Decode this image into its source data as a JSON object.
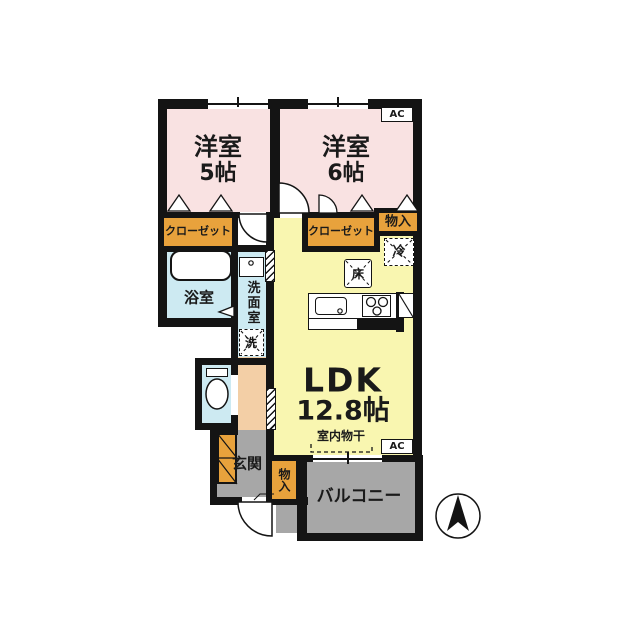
{
  "plan": {
    "rooms": {
      "room5": {
        "name": "洋室",
        "size": "5帖"
      },
      "room6": {
        "name": "洋室",
        "size": "6帖"
      },
      "ldk": {
        "name": "LDK",
        "size": "12.8帖"
      },
      "bathroom": {
        "name": "浴室"
      },
      "washroom": {
        "name": "洗面室"
      },
      "entrance": {
        "name": "玄関"
      },
      "balcony": {
        "name": "バルコニー"
      }
    },
    "features": {
      "closet_left": "クローゼット",
      "closet_right": "クローゼット",
      "storage_top": "物入",
      "storage_bottom": "物入",
      "fridge": "冷",
      "washer": "洗",
      "floor_storage": "床",
      "indoor_drying": "室内物干",
      "ac_room6": "AC",
      "ac_ldk": "AC"
    },
    "compass": {
      "direction": "north"
    },
    "colors": {
      "wall": "#141414",
      "western_room": "#f9e2e2",
      "ldk": "#f9f6b0",
      "wet_area": "#cdeaf2",
      "hall": "#f3cfa6",
      "outdoor": "#a7a7a7",
      "storage": "#e8a23c"
    }
  }
}
